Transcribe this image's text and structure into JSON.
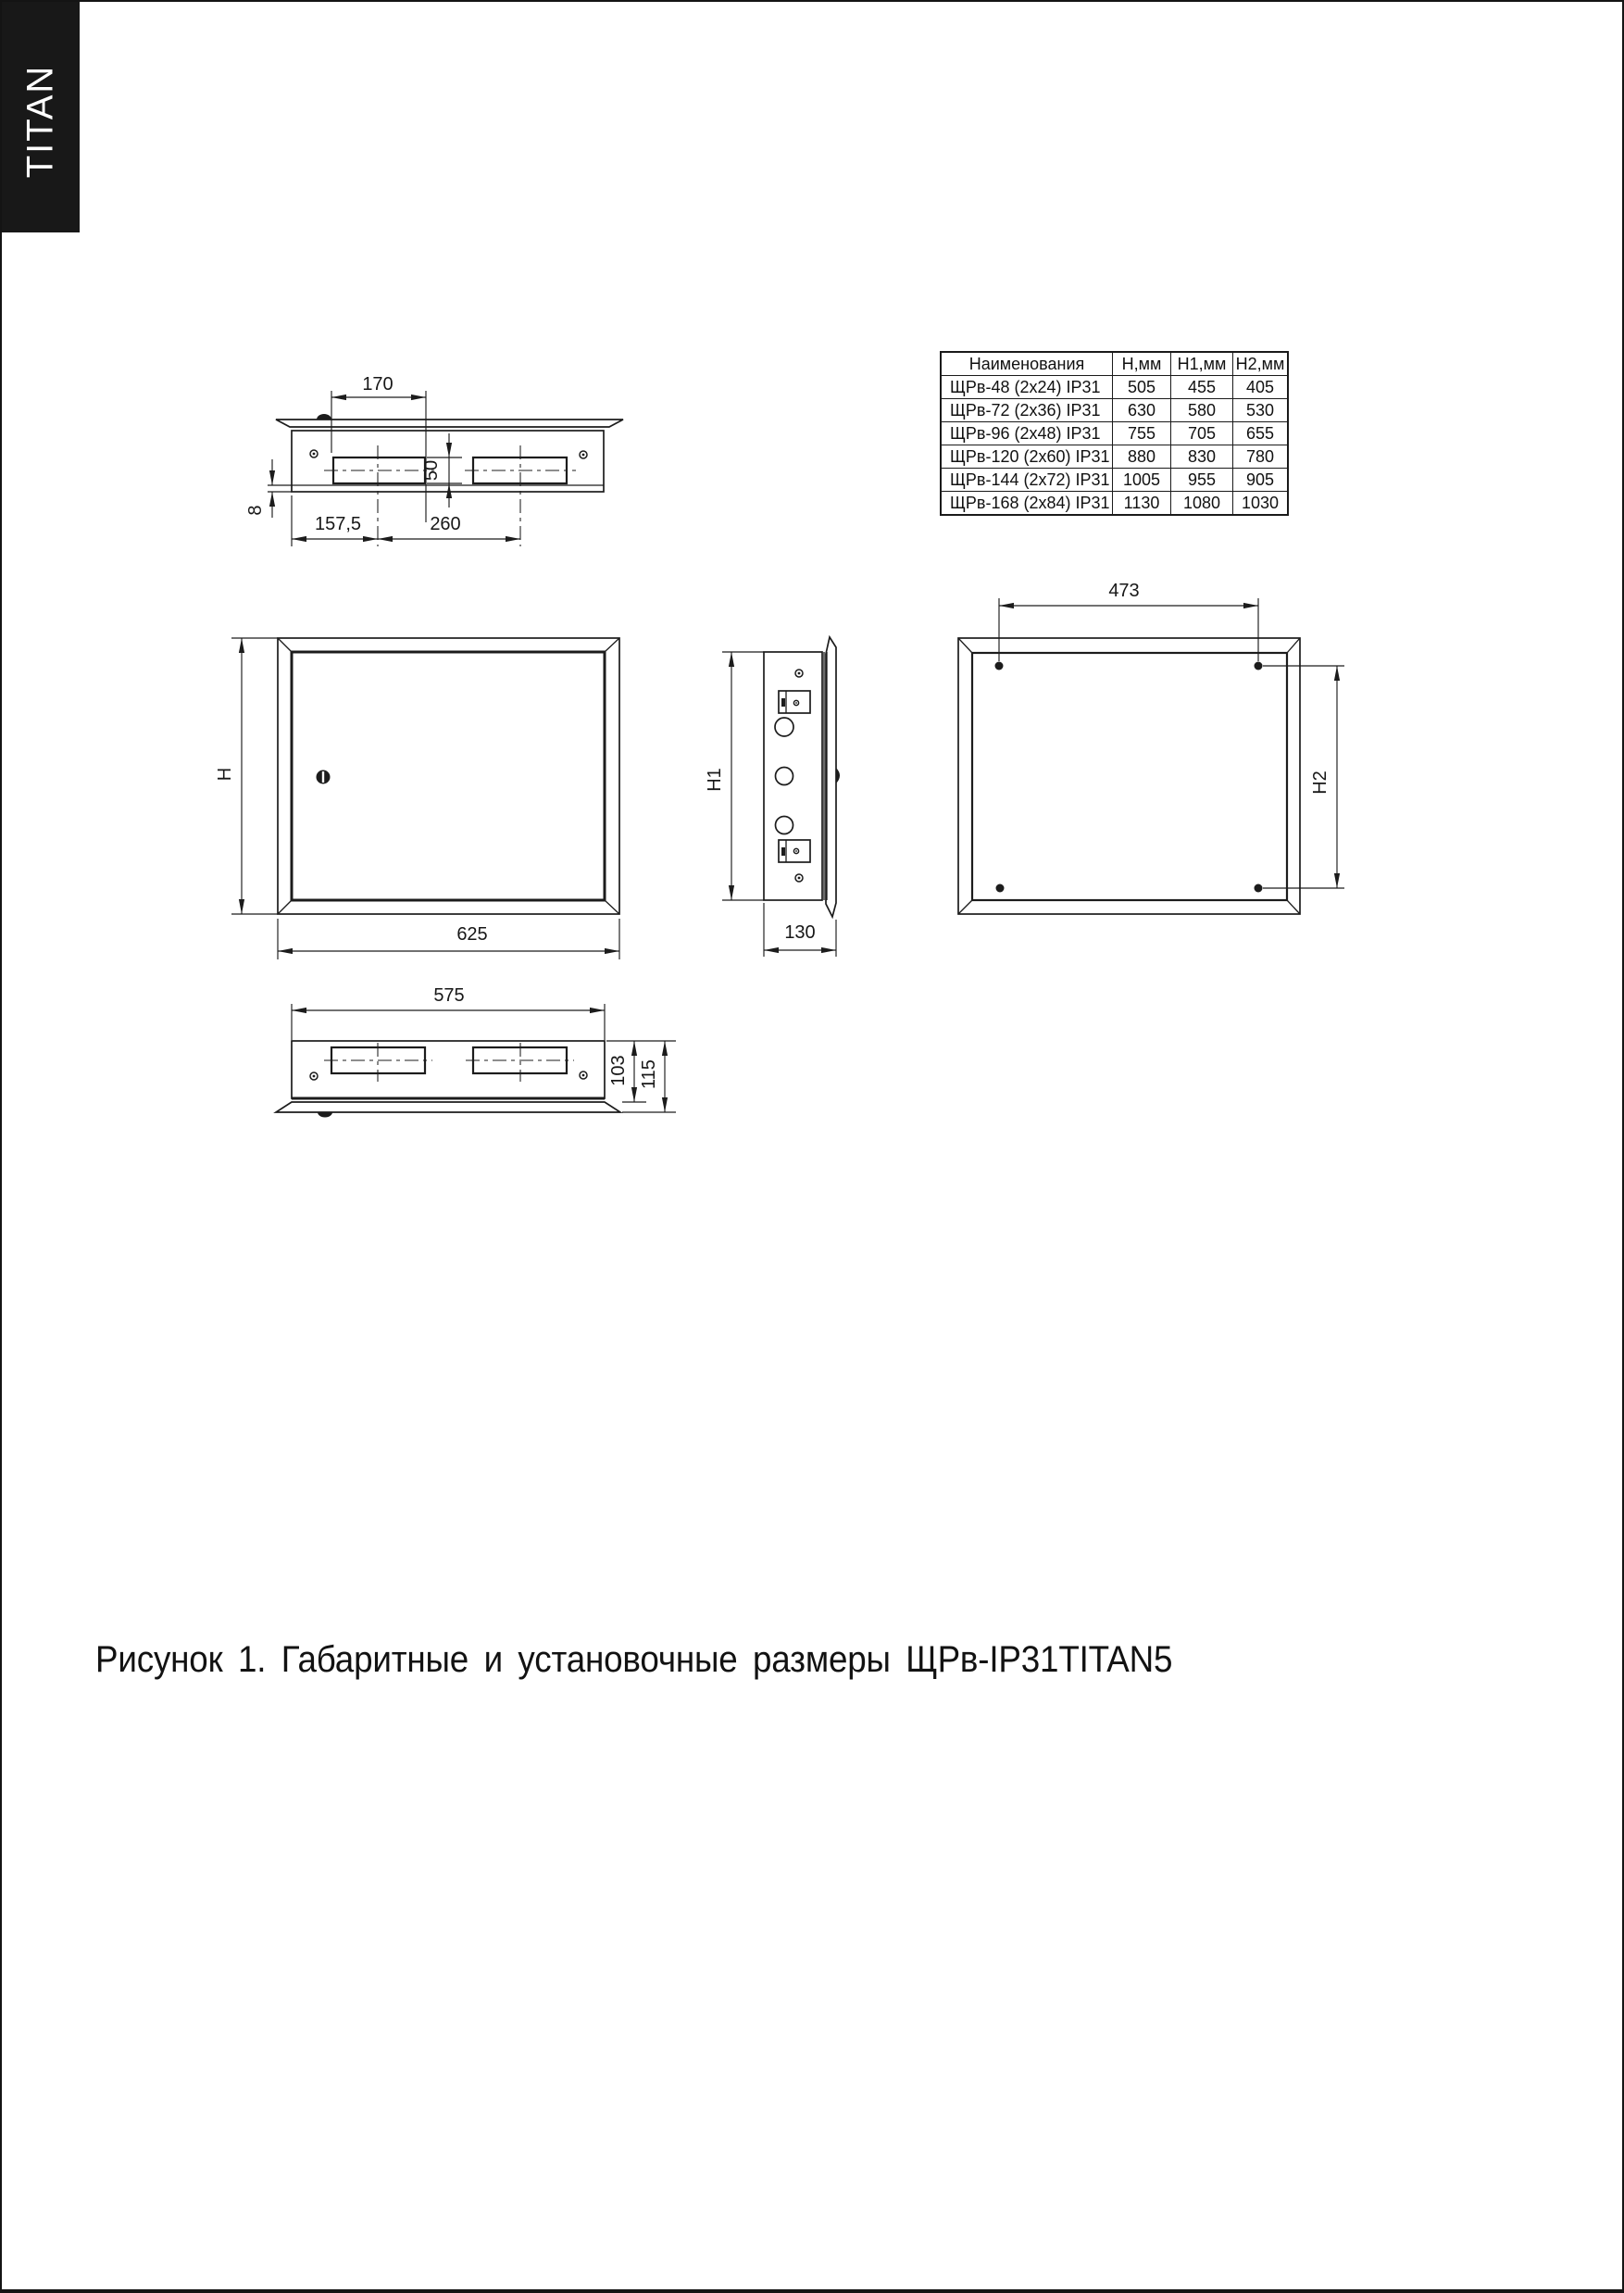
{
  "page": {
    "brand": "TITAN"
  },
  "spec_table": {
    "headers": [
      "Наименования",
      "Н,мм",
      "Н1,мм",
      "Н2,мм"
    ],
    "rows": [
      [
        "ЩРв-48 (2х24) IP31",
        "505",
        "455",
        "405"
      ],
      [
        "ЩРв-72 (2х36) IP31",
        "630",
        "580",
        "530"
      ],
      [
        "ЩРв-96 (2х48) IP31",
        "755",
        "705",
        "655"
      ],
      [
        "ЩРв-120 (2х60) IP31",
        "880",
        "830",
        "780"
      ],
      [
        "ЩРв-144 (2х72) IP31",
        "1005",
        "955",
        "905"
      ],
      [
        "ЩРв-168 (2х84) IP31",
        "1130",
        "1080",
        "1030"
      ]
    ]
  },
  "dims": {
    "top_view": {
      "cutout_width": "170",
      "cutout_height": "50",
      "rear_offset": "8",
      "edge_to_center": "157,5",
      "center_spacing": "260"
    },
    "front_view": {
      "height": "H",
      "width": "625"
    },
    "side_view": {
      "height": "H1",
      "depth": "130"
    },
    "back_view": {
      "hole_spacing_width": "473",
      "hole_spacing_height": "H2"
    },
    "bottom_view": {
      "width": "575",
      "body_depth": "103",
      "overall_depth": "115"
    }
  },
  "caption": "Рисунок 1. Габаритные и установочные размеры ЩРв-IP31TITAN5"
}
